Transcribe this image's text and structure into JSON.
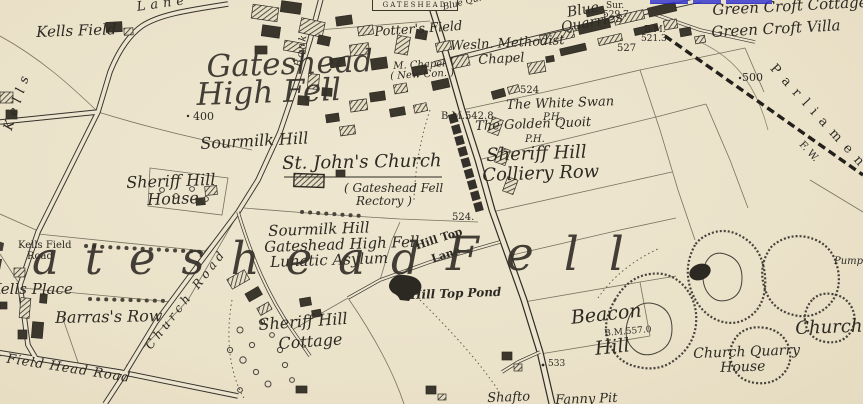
{
  "map": {
    "title": "Ordnance Survey style map extract - Gateshead Fell / Sheriff Hill",
    "colors": {
      "paper": "#ebe2ca",
      "ink": "#2d2a23",
      "link_blue": "#3b3bd2"
    },
    "sheet_label": "GATESHEAD",
    "stretched": {
      "word1": "Gateshead",
      "word2": "Fell"
    },
    "labels": {
      "kells_field": "Kells Field",
      "kells_lane_kells": "Kells",
      "kells_lane_lane": "Lane",
      "big_gateshead": "Gateshead",
      "big_high_fell": "High Fell",
      "spot_400": "400",
      "sourmilk_hill_n": "Sourmilk Hill",
      "sheriff_hill_house_1": "Sheriff Hill",
      "sheriff_hill_house_2": "House",
      "st_johns_church": "St. John's Church",
      "rectory_1": "( Gateshead Fell",
      "rectory_2": "Rectory )",
      "asylum_1": "Sourmilk Hill",
      "asylum_2": "Gateshead High Fell",
      "asylum_3": "Lunatic Asylum",
      "hill_top_lane_1": "Hill Top",
      "hill_top_lane_2": "Lane",
      "spot_524_road": "524.",
      "spot_524_n": "524",
      "bm_542": "B.M.542.8",
      "white_swan_1": "The White Swan",
      "white_swan_2": "P.H.",
      "golden_quoit_1": "The Golden Quoit",
      "golden_quoit_2": "P.H.",
      "colliery_1": "Sheriff Hill",
      "colliery_2": "Colliery Row",
      "blue_quarries_1": "Blue",
      "blue_quarries_2": "Quarries",
      "sur_1": "Sur.",
      "sur_2": "529.7",
      "bm_521_1": "B.M.",
      "bm_521_2": "521.3",
      "spot_527": "527",
      "green_croft_cottage": "Green Croft Cottage",
      "green_croft_villa": "Green Croft Villa",
      "spot_500": "500",
      "parliament": "P a r l i a m e n t",
      "fw": "F. W.",
      "blue_qu": "Blue Qu.",
      "potters_field": "Potter's Field",
      "methodist_1": "Wesln. Methodist",
      "methodist_2": "Chapel",
      "m_chapel_1": "M. Chapel",
      "m_chapel_2": "( New Con. )",
      "bank": "Bank",
      "church_road": "Church Road",
      "kells_field_road_1": "Kells Field",
      "kells_field_road_2": "Road",
      "kells_place": "Kells Place",
      "barrass_row": "Barras's Row",
      "field_head_road": "Kells Field Head Road",
      "cottage_1": "Sheriff Hill",
      "cottage_2": "Cottage",
      "hill_top_pond": "Hill Top Pond",
      "beacon_1": "Beacon",
      "beacon_2": "Hill",
      "bm_557": "B.M.557.0",
      "spot_533": "533",
      "church_quarry_1": "Church Quarry",
      "church_quarry_2": "House",
      "church_e": "Church",
      "pump": "Pump",
      "shafto": "Shafto",
      "fanny_pit": "Fanny Pit"
    }
  }
}
